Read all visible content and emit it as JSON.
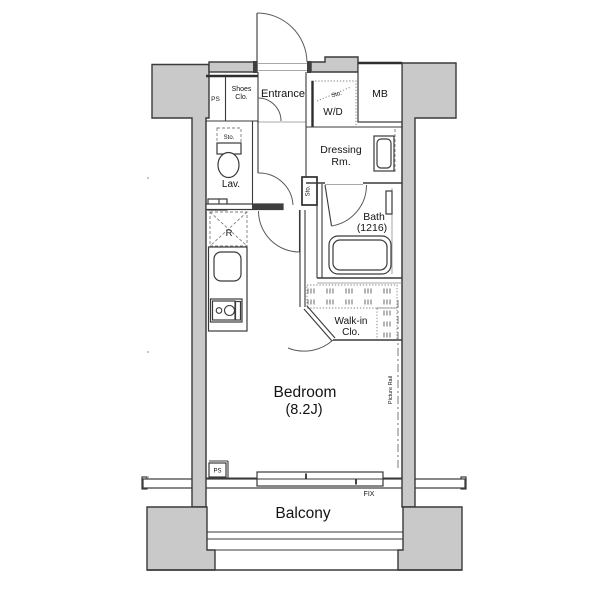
{
  "plan": {
    "labels": {
      "entrance": "Entrance",
      "ps_top": "PS",
      "shoes_1": "Shoes",
      "shoes_2": "Clo.",
      "mb": "MB",
      "wd": "W/D",
      "wd_sto": "Sto.",
      "lav": "Lav.",
      "lav_sto": "Sto.",
      "hall_sto": "Sto.",
      "dressing_1": "Dressing",
      "dressing_2": "Rm.",
      "bath_1": "Bath",
      "bath_2": "(1216)",
      "fridge": "R",
      "walkin_1": "Walk-in",
      "walkin_2": "Clo.",
      "bedroom_1": "Bedroom",
      "bedroom_2": "(8.2J)",
      "picture_rail": "Picture Rail",
      "ps_bottom": "PS",
      "fix": "FIX",
      "balcony": "Balcony"
    },
    "colors": {
      "wall_fill": "#c9c9c9",
      "line": "#3a3a3a",
      "text": "#141414",
      "background": "#ffffff"
    }
  }
}
